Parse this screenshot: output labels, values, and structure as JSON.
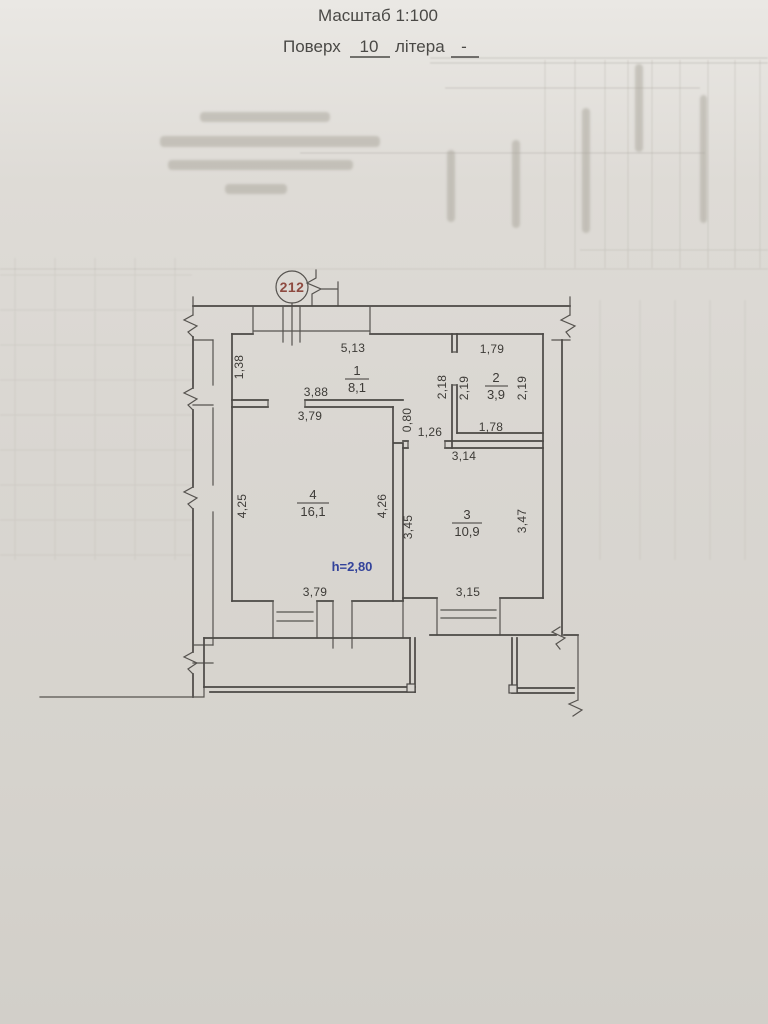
{
  "header": {
    "scale_title": "Масштаб 1:100",
    "floor_label": "Поверх",
    "floor_value": "10",
    "letter_label": "літера",
    "letter_value": "-"
  },
  "plan": {
    "apartment_number": "212",
    "ceiling_height": "h=2,80",
    "rooms": [
      {
        "number": "1",
        "area": "8,1"
      },
      {
        "number": "2",
        "area": "3,9"
      },
      {
        "number": "3",
        "area": "10,9"
      },
      {
        "number": "4",
        "area": "16,1"
      }
    ],
    "dims": {
      "r1_top": "5,13",
      "r1_left": "1,38",
      "r1_bottom": "3,88",
      "r4_top": "3,79",
      "r2_top": "1,79",
      "hall_left": "2,18",
      "r2_left": "2,19",
      "r2_right": "2,19",
      "r2_bottom": "1,78",
      "passage_height": "0,80",
      "passage_width": "1,26",
      "r3_top": "3,14",
      "r4_left": "4,25",
      "r4_right": "4,26",
      "r3_left": "3,45",
      "r3_right": "3,47",
      "r4_bottom": "3,79",
      "r3_bottom": "3,15",
      "r3_area_label": "10,9"
    },
    "colors": {
      "ink": "#4b4845",
      "apartment_number": "#8e4a40",
      "height_note": "#33439b"
    }
  }
}
